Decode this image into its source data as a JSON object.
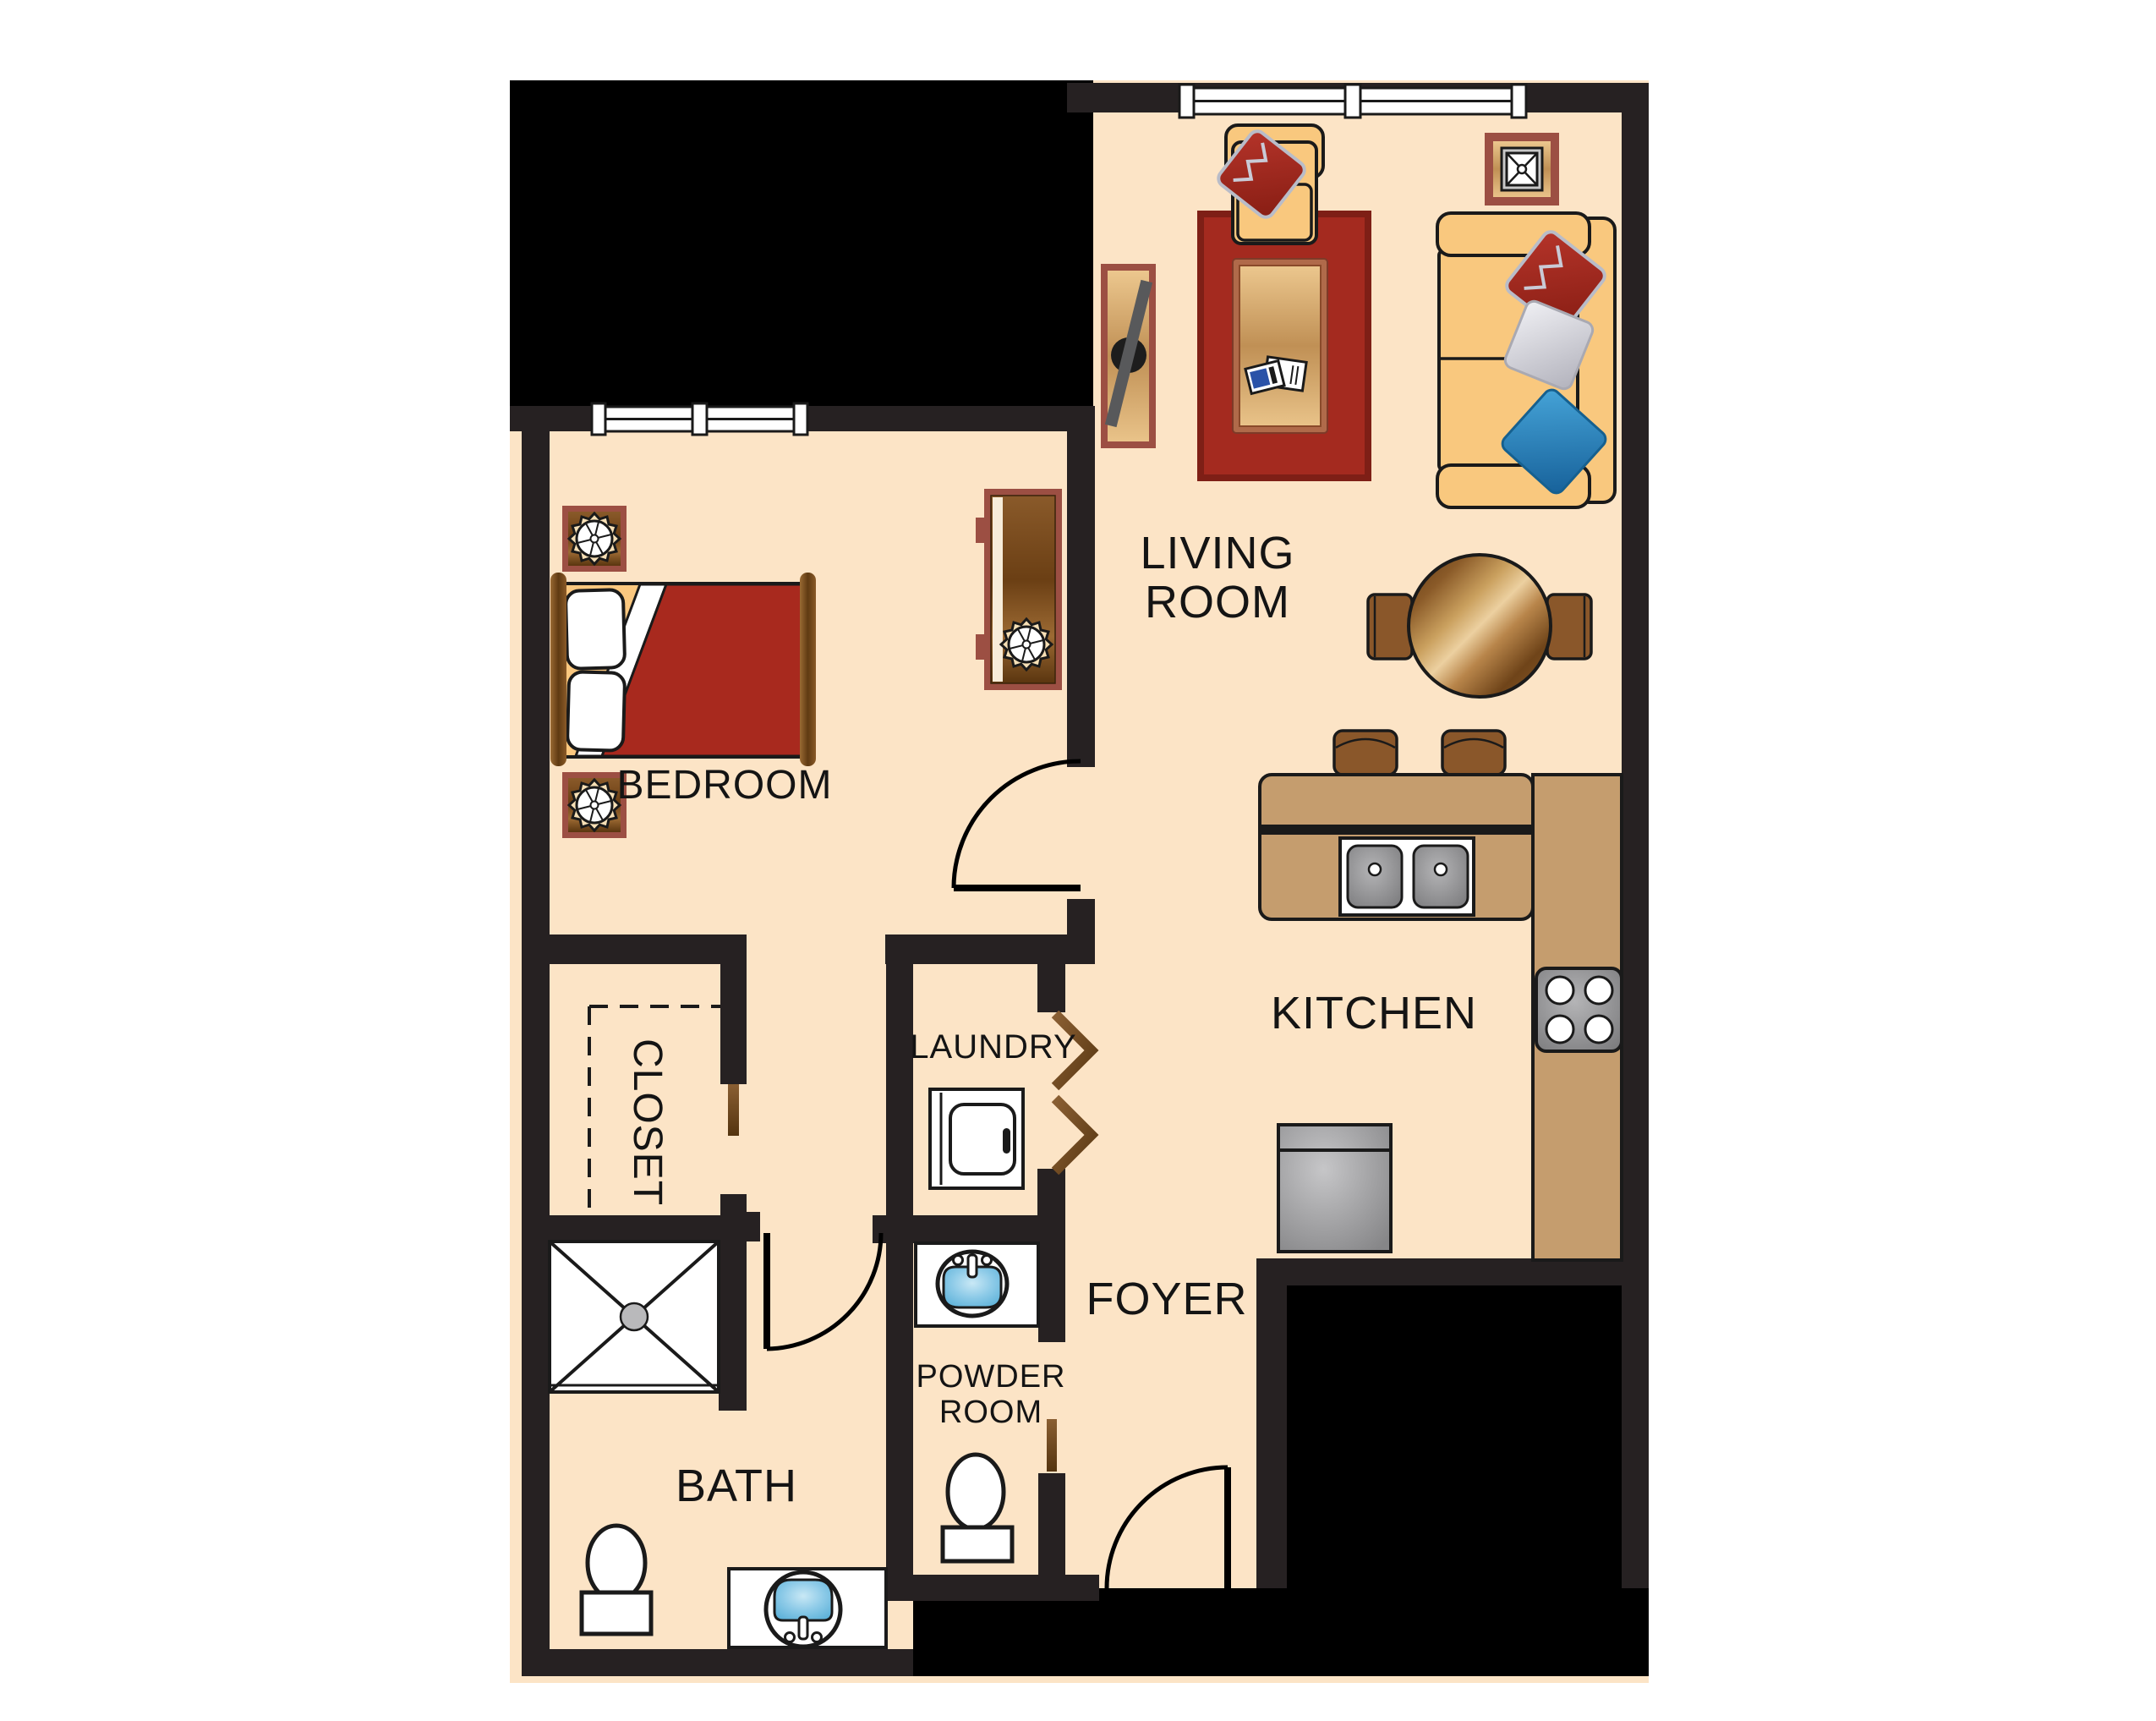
{
  "diagram_type": "apartment-floor-plan",
  "labels": {
    "living_room_line1": "LIVING",
    "living_room_line2": "ROOM",
    "bedroom": "BEDROOM",
    "kitchen": "KITCHEN",
    "laundry": "LAUNDRY",
    "closet": "CLOSET",
    "bath": "BATH",
    "foyer": "FOYER",
    "powder_room_line1": "POWDER",
    "powder_room_line2": "ROOM"
  },
  "colors": {
    "floor": "#fce4c6",
    "wall": "#262122",
    "exterior_fill": "#000000",
    "counter_tan": "#c59d6e",
    "furniture_tan": "#f9c87e",
    "rug_red": "#a42a1f",
    "blanket_red": "#a8291e",
    "accent_maroon": "#9c4f43",
    "wood_brown": "#8a572a",
    "door_wood": "#7a4e1f",
    "pillow_blue": "#2e86bd",
    "sink_blue": "#7cc4e4",
    "appliance_gray": "#9b9b9d",
    "text": "#141414"
  },
  "fixtures": [
    "sofa",
    "armchair",
    "rug",
    "coffee-table",
    "tv-console",
    "end-table",
    "dining-table",
    "bar-stools",
    "kitchen-island",
    "double-sink",
    "stove",
    "dishwasher",
    "washer",
    "bed",
    "nightstands",
    "dresser",
    "shower",
    "toilets",
    "vanity-sinks"
  ]
}
